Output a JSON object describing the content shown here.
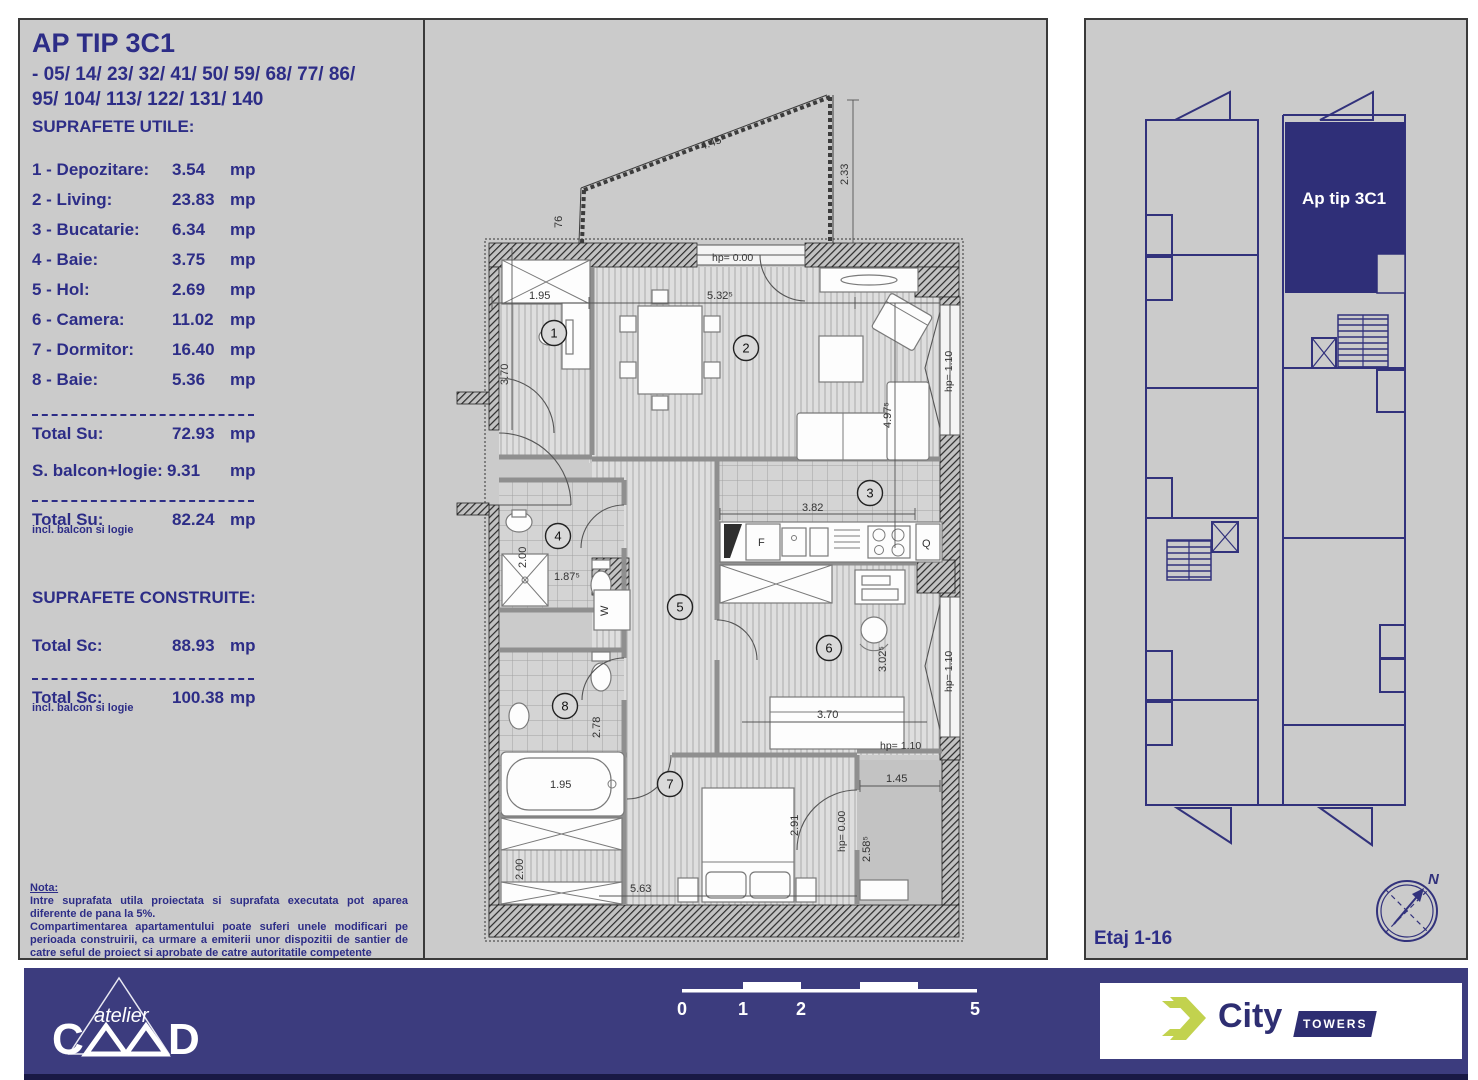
{
  "left_panel": {
    "title": "AP TIP 3C1",
    "subtitle_line1": "- 05/ 14/ 23/ 32/ 41/ 50/ 59/ 68/ 77/ 86/",
    "subtitle_line2": "95/ 104/ 113/ 122/ 131/ 140",
    "section1_heading": "SUPRAFETE UTILE:",
    "rooms": [
      {
        "label": "1 - Depozitare:",
        "value": "3.54",
        "unit": "mp"
      },
      {
        "label": "2 - Living:",
        "value": "23.83",
        "unit": "mp"
      },
      {
        "label": "3 - Bucatarie:",
        "value": "6.34",
        "unit": "mp"
      },
      {
        "label": "4 - Baie:",
        "value": "3.75",
        "unit": "mp"
      },
      {
        "label": "5 - Hol:",
        "value": "2.69",
        "unit": "mp"
      },
      {
        "label": "6 - Camera:",
        "value": "11.02",
        "unit": "mp"
      },
      {
        "label": "7 - Dormitor:",
        "value": "16.40",
        "unit": "mp"
      },
      {
        "label": "8 - Baie:",
        "value": "5.36",
        "unit": "mp"
      }
    ],
    "total_su": {
      "label": "Total Su:",
      "value": "72.93",
      "unit": "mp"
    },
    "balcon": {
      "label": "S. balcon+logie:",
      "value": "9.31",
      "unit": "mp"
    },
    "total_su_incl": {
      "label": "Total Su:",
      "value": "82.24",
      "unit": "mp",
      "note": "incl. balcon si logie"
    },
    "section2_heading": "SUPRAFETE CONSTRUITE:",
    "total_sc": {
      "label": "Total Sc:",
      "value": "88.93",
      "unit": "mp"
    },
    "total_sc_incl": {
      "label": "Total Sc:",
      "value": "100.38",
      "unit": "mp",
      "note": "incl. balcon si logie"
    },
    "nota_title": "Nota:",
    "nota_line1": "Intre suprafata utila proiectata si suprafata executata pot aparea diferente de pana la 5%.",
    "nota_line2": "Compartimentarea apartamentului poate suferi unele modificari pe perioada construirii, ca urmare a emiterii unor dispozitii de santier de catre seful de proiect si aprobate de catre autoritatile competente"
  },
  "plan": {
    "room_numbers": {
      "r1": "1",
      "r2": "2",
      "r3": "3",
      "r4": "4",
      "r5": "5",
      "r6": "6",
      "r7": "7",
      "r8": "8"
    },
    "labels": {
      "balcony_len": "4.45⁵",
      "balcony_left": "76",
      "balcony_right": "2.33",
      "hp_top": "hp= 0.00",
      "dim_195_top": "1.95",
      "dim_532": "5.32⁵",
      "dim_370_left": "3.70",
      "dim_497": "4.97⁵",
      "hp_right_top": "hp= 1.10",
      "dim_382": "3.82",
      "fridge": "F",
      "oven": "Q",
      "washer": "W",
      "dim_200_bath": "2.00",
      "dim_187": "1.87⁵",
      "dim_302": "3.02⁵",
      "dim_370_room6": "3.70",
      "hp_right_mid": "hp= 1.10",
      "dim_278": "2.78",
      "dim_195_tub": "1.95",
      "dim_200_storage": "2.00",
      "dim_563": "5.63",
      "dim_291": "2.91",
      "hp_balcony_door": "hp= 0.00",
      "dim_258": "2.58⁵",
      "dim_145": "1.45",
      "hp_parapet": "hp= 1.10"
    }
  },
  "right_panel": {
    "apartment_label": "Ap tip 3C1",
    "floor_label": "Etaj 1-16",
    "compass_n": "N"
  },
  "footer": {
    "scale": {
      "t0": "0",
      "t1": "1",
      "t2": "2",
      "t5": "5"
    },
    "caad": {
      "script": "atelier",
      "c": "C",
      "d": "D"
    },
    "xcity": {
      "city": "City",
      "towers": "TOWERS"
    }
  },
  "colors": {
    "navy_text": "#2d2d87",
    "footer_bg": "#3c3c7e",
    "highlight_apartment": "#2f2f78",
    "lime": "#c2d24e",
    "sheet_bg": "#cbcbcb"
  }
}
